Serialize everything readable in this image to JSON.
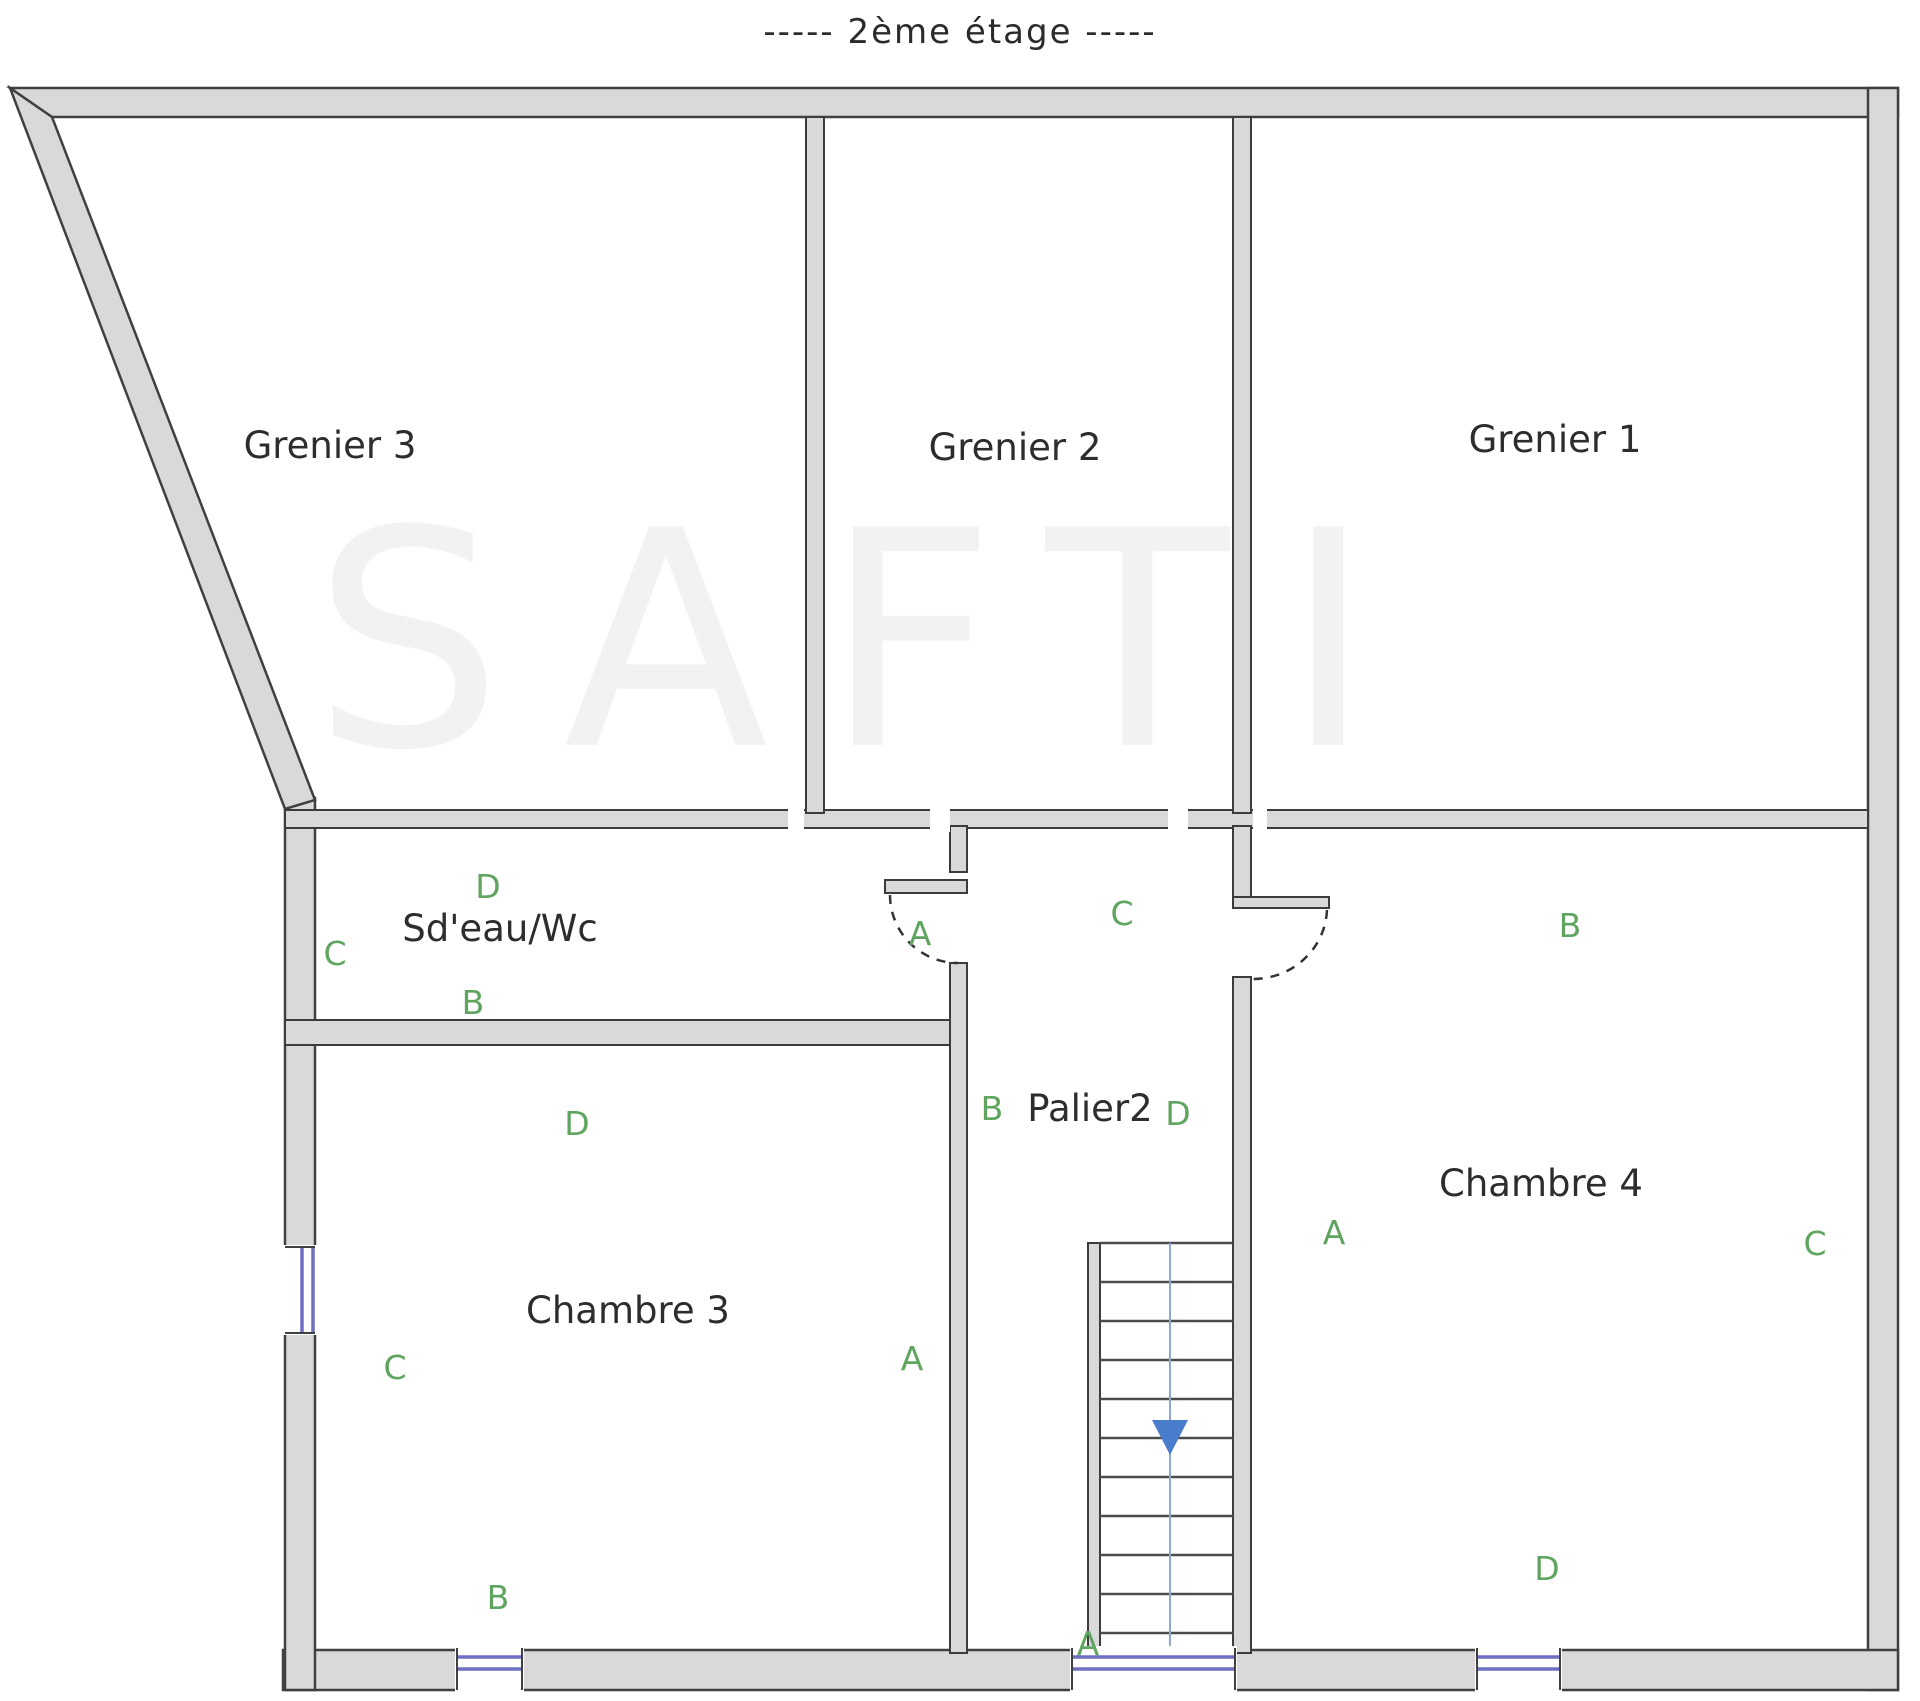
{
  "title": {
    "text": "-----  2ème étage  -----"
  },
  "watermark": {
    "text": "SAFTI"
  },
  "colors": {
    "wall_fill": "#d9d9d9",
    "wall_stroke": "#404040",
    "window_glass": "#6e6ec2",
    "orientation_letter": "#5fa55f",
    "stairs_arrow": "#4a7ccc",
    "room_label": "#2d2d2d",
    "title": "#2b2b2b"
  },
  "canvas": {
    "width": 1920,
    "height": 1701
  },
  "rooms": [
    {
      "name": "room-label-grenier-3",
      "label": "Grenier 3",
      "x": 330,
      "y": 458
    },
    {
      "name": "room-label-grenier-2",
      "label": "Grenier 2",
      "x": 1015,
      "y": 460
    },
    {
      "name": "room-label-grenier-1",
      "label": "Grenier 1",
      "x": 1555,
      "y": 452
    },
    {
      "name": "room-label-sdeau-wc",
      "label": "Sd'eau/Wc",
      "x": 500,
      "y": 941
    },
    {
      "name": "room-label-palier2",
      "label": "Palier2",
      "x": 1090,
      "y": 1121
    },
    {
      "name": "room-label-chambre-3",
      "label": "Chambre 3",
      "x": 628,
      "y": 1323
    },
    {
      "name": "room-label-chambre-4",
      "label": "Chambre 4",
      "x": 1541,
      "y": 1196
    }
  ],
  "orientation_letters": [
    {
      "name": "letter-d-sdeau",
      "letter": "D",
      "x": 488,
      "y": 898
    },
    {
      "name": "letter-c-sdeau",
      "letter": "C",
      "x": 335,
      "y": 965
    },
    {
      "name": "letter-b-sdeau",
      "letter": "B",
      "x": 473,
      "y": 1014
    },
    {
      "name": "letter-a-sdeau",
      "letter": "A",
      "x": 920,
      "y": 945
    },
    {
      "name": "letter-c-palier",
      "letter": "C",
      "x": 1122,
      "y": 925
    },
    {
      "name": "letter-b-palier",
      "letter": "B",
      "x": 992,
      "y": 1120
    },
    {
      "name": "letter-d-palier",
      "letter": "D",
      "x": 1178,
      "y": 1125
    },
    {
      "name": "letter-a-palier",
      "letter": "A",
      "x": 1088,
      "y": 1655
    },
    {
      "name": "letter-d-chambre3",
      "letter": "D",
      "x": 577,
      "y": 1135
    },
    {
      "name": "letter-c-chambre3",
      "letter": "C",
      "x": 395,
      "y": 1379
    },
    {
      "name": "letter-b-chambre3",
      "letter": "B",
      "x": 498,
      "y": 1609
    },
    {
      "name": "letter-a-chambre3",
      "letter": "A",
      "x": 912,
      "y": 1370
    },
    {
      "name": "letter-b-chambre4",
      "letter": "B",
      "x": 1570,
      "y": 937
    },
    {
      "name": "letter-a-chambre4",
      "letter": "A",
      "x": 1334,
      "y": 1244
    },
    {
      "name": "letter-c-chambre4",
      "letter": "C",
      "x": 1815,
      "y": 1255
    },
    {
      "name": "letter-d-chambre4",
      "letter": "D",
      "x": 1547,
      "y": 1580
    }
  ],
  "shapes": [
    {
      "name": "top-wall",
      "type": "polygon",
      "cls": "wx",
      "attrs": {
        "points": "10,88 1898,88 1898,117 52,117"
      }
    },
    {
      "name": "right-wall",
      "type": "rect",
      "cls": "wx",
      "attrs": {
        "x": 1868,
        "y": 88,
        "width": 30,
        "height": 1602
      }
    },
    {
      "name": "bottom-wall",
      "type": "rect",
      "cls": "wx",
      "attrs": {
        "x": 283,
        "y": 1650,
        "width": 1615,
        "height": 40
      }
    },
    {
      "name": "left-wall",
      "type": "rect",
      "cls": "wx",
      "attrs": {
        "x": 285,
        "y": 798,
        "width": 30,
        "height": 892
      }
    },
    {
      "name": "slanted-wall",
      "type": "polygon",
      "cls": "wx",
      "attrs": {
        "points": "10,88 52,117 315,800 285,809"
      }
    },
    {
      "name": "greniers-bottom-wall",
      "type": "rect",
      "cls": "wi",
      "attrs": {
        "x": 285,
        "y": 810,
        "width": 1583,
        "height": 18
      }
    },
    {
      "name": "wall-grenier3-grenier2",
      "type": "rect",
      "cls": "wi",
      "attrs": {
        "x": 806,
        "y": 117,
        "width": 18,
        "height": 696
      }
    },
    {
      "name": "wall-grenier2-grenier1",
      "type": "rect",
      "cls": "wi",
      "attrs": {
        "x": 1233,
        "y": 117,
        "width": 18,
        "height": 696
      }
    },
    {
      "name": "sdeau-bottom-wall",
      "type": "rect",
      "cls": "wi",
      "attrs": {
        "x": 285,
        "y": 1020,
        "width": 682,
        "height": 25
      }
    },
    {
      "name": "palier-left-wall-upper",
      "type": "rect",
      "cls": "wi",
      "attrs": {
        "x": 950,
        "y": 826,
        "width": 17,
        "height": 46
      }
    },
    {
      "name": "sdeau-door-stub",
      "type": "rect",
      "cls": "wi",
      "attrs": {
        "x": 885,
        "y": 880,
        "width": 82,
        "height": 13
      }
    },
    {
      "name": "palier-left-wall-lower",
      "type": "rect",
      "cls": "wi",
      "attrs": {
        "x": 950,
        "y": 963,
        "width": 17,
        "height": 690
      }
    },
    {
      "name": "chambre4-left-wall-upper",
      "type": "rect",
      "cls": "wi",
      "attrs": {
        "x": 1233,
        "y": 826,
        "width": 18,
        "height": 73
      }
    },
    {
      "name": "chambre4-door-stub",
      "type": "rect",
      "cls": "wi",
      "attrs": {
        "x": 1233,
        "y": 897,
        "width": 96,
        "height": 11
      }
    },
    {
      "name": "chambre4-left-wall-lower",
      "type": "rect",
      "cls": "wi",
      "attrs": {
        "x": 1233,
        "y": 977,
        "width": 18,
        "height": 676
      }
    },
    {
      "name": "stairs-left-wall",
      "type": "rect",
      "cls": "wi",
      "attrs": {
        "x": 1088,
        "y": 1243,
        "width": 12,
        "height": 407
      }
    },
    {
      "name": "band-opening-1",
      "type": "rect",
      "cls": "gap",
      "attrs": {
        "x": 788,
        "y": 806,
        "width": 16,
        "height": 26
      }
    },
    {
      "name": "band-opening-2",
      "type": "rect",
      "cls": "gap",
      "attrs": {
        "x": 930,
        "y": 806,
        "width": 20,
        "height": 26
      }
    },
    {
      "name": "band-opening-3",
      "type": "rect",
      "cls": "gap",
      "attrs": {
        "x": 1168,
        "y": 806,
        "width": 20,
        "height": 26
      }
    },
    {
      "name": "band-opening-4",
      "type": "rect",
      "cls": "gap",
      "attrs": {
        "x": 1253,
        "y": 806,
        "width": 14,
        "height": 26
      }
    },
    {
      "name": "left-window-gap",
      "type": "rect",
      "cls": "gap",
      "attrs": {
        "x": 281,
        "y": 1245,
        "width": 36,
        "height": 90
      }
    },
    {
      "name": "left-window-glass-1",
      "type": "line",
      "cls": "win",
      "attrs": {
        "x1": 302,
        "y1": 1247,
        "x2": 302,
        "y2": 1333
      }
    },
    {
      "name": "left-window-glass-2",
      "type": "line",
      "cls": "win",
      "attrs": {
        "x1": 313,
        "y1": 1247,
        "x2": 313,
        "y2": 1333
      }
    },
    {
      "name": "left-window-jamb-top",
      "type": "line",
      "cls": "jamb",
      "attrs": {
        "x1": 285,
        "y1": 1247,
        "x2": 315,
        "y2": 1247
      }
    },
    {
      "name": "left-window-jamb-bottom",
      "type": "line",
      "cls": "jamb",
      "attrs": {
        "x1": 285,
        "y1": 1333,
        "x2": 315,
        "y2": 1333
      }
    },
    {
      "name": "bottom-window1-gap",
      "type": "rect",
      "cls": "gap",
      "attrs": {
        "x": 455,
        "y": 1646,
        "width": 69,
        "height": 46
      }
    },
    {
      "name": "bottom-window1-glass-1",
      "type": "line",
      "cls": "win",
      "attrs": {
        "x1": 457,
        "y1": 1657,
        "x2": 522,
        "y2": 1657
      }
    },
    {
      "name": "bottom-window1-glass-2",
      "type": "line",
      "cls": "win",
      "attrs": {
        "x1": 457,
        "y1": 1669,
        "x2": 522,
        "y2": 1669
      }
    },
    {
      "name": "bottom-window1-jamb-left",
      "type": "line",
      "cls": "jamb",
      "attrs": {
        "x1": 457,
        "y1": 1648,
        "x2": 457,
        "y2": 1690
      }
    },
    {
      "name": "bottom-window1-jamb-right",
      "type": "line",
      "cls": "jamb",
      "attrs": {
        "x1": 522,
        "y1": 1648,
        "x2": 522,
        "y2": 1690
      }
    },
    {
      "name": "bottom-window2-gap",
      "type": "rect",
      "cls": "gap",
      "attrs": {
        "x": 1070,
        "y": 1646,
        "width": 167,
        "height": 46
      }
    },
    {
      "name": "bottom-window2-glass-1",
      "type": "line",
      "cls": "win",
      "attrs": {
        "x1": 1072,
        "y1": 1657,
        "x2": 1235,
        "y2": 1657
      }
    },
    {
      "name": "bottom-window2-glass-2",
      "type": "line",
      "cls": "win",
      "attrs": {
        "x1": 1072,
        "y1": 1669,
        "x2": 1235,
        "y2": 1669
      }
    },
    {
      "name": "bottom-window2-jamb-left",
      "type": "line",
      "cls": "jamb",
      "attrs": {
        "x1": 1072,
        "y1": 1648,
        "x2": 1072,
        "y2": 1690
      }
    },
    {
      "name": "bottom-window2-jamb-right",
      "type": "line",
      "cls": "jamb",
      "attrs": {
        "x1": 1235,
        "y1": 1648,
        "x2": 1235,
        "y2": 1690
      }
    },
    {
      "name": "bottom-window3-gap",
      "type": "rect",
      "cls": "gap",
      "attrs": {
        "x": 1475,
        "y": 1646,
        "width": 87,
        "height": 46
      }
    },
    {
      "name": "bottom-window3-glass-1",
      "type": "line",
      "cls": "win",
      "attrs": {
        "x1": 1477,
        "y1": 1657,
        "x2": 1560,
        "y2": 1657
      }
    },
    {
      "name": "bottom-window3-glass-2",
      "type": "line",
      "cls": "win",
      "attrs": {
        "x1": 1477,
        "y1": 1669,
        "x2": 1560,
        "y2": 1669
      }
    },
    {
      "name": "bottom-window3-jamb-left",
      "type": "line",
      "cls": "jamb",
      "attrs": {
        "x1": 1477,
        "y1": 1648,
        "x2": 1477,
        "y2": 1690
      }
    },
    {
      "name": "bottom-window3-jamb-right",
      "type": "line",
      "cls": "jamb",
      "attrs": {
        "x1": 1560,
        "y1": 1648,
        "x2": 1560,
        "y2": 1690
      }
    },
    {
      "name": "sdeau-door-arc",
      "type": "path",
      "cls": "door",
      "attrs": {
        "d": "M 890 895 A 68 68 0 0 0 958 963"
      }
    },
    {
      "name": "chambre4-door-arc",
      "type": "path",
      "cls": "door",
      "attrs": {
        "d": "M 1327 910 A 74 72 0 0 1 1253 979"
      }
    },
    {
      "name": "stair-tread-1",
      "type": "line",
      "cls": "tread",
      "attrs": {
        "x1": 1100,
        "y1": 1243,
        "x2": 1233,
        "y2": 1243
      }
    },
    {
      "name": "stair-tread-2",
      "type": "line",
      "cls": "tread",
      "attrs": {
        "x1": 1100,
        "y1": 1282,
        "x2": 1233,
        "y2": 1282
      }
    },
    {
      "name": "stair-tread-3",
      "type": "line",
      "cls": "tread",
      "attrs": {
        "x1": 1100,
        "y1": 1321,
        "x2": 1233,
        "y2": 1321
      }
    },
    {
      "name": "stair-tread-4",
      "type": "line",
      "cls": "tread",
      "attrs": {
        "x1": 1100,
        "y1": 1360,
        "x2": 1233,
        "y2": 1360
      }
    },
    {
      "name": "stair-tread-5",
      "type": "line",
      "cls": "tread",
      "attrs": {
        "x1": 1100,
        "y1": 1399,
        "x2": 1233,
        "y2": 1399
      }
    },
    {
      "name": "stair-tread-6",
      "type": "line",
      "cls": "tread",
      "attrs": {
        "x1": 1100,
        "y1": 1438,
        "x2": 1233,
        "y2": 1438
      }
    },
    {
      "name": "stair-tread-7",
      "type": "line",
      "cls": "tread",
      "attrs": {
        "x1": 1100,
        "y1": 1477,
        "x2": 1233,
        "y2": 1477
      }
    },
    {
      "name": "stair-tread-8",
      "type": "line",
      "cls": "tread",
      "attrs": {
        "x1": 1100,
        "y1": 1516,
        "x2": 1233,
        "y2": 1516
      }
    },
    {
      "name": "stair-tread-9",
      "type": "line",
      "cls": "tread",
      "attrs": {
        "x1": 1100,
        "y1": 1555,
        "x2": 1233,
        "y2": 1555
      }
    },
    {
      "name": "stair-tread-10",
      "type": "line",
      "cls": "tread",
      "attrs": {
        "x1": 1100,
        "y1": 1594,
        "x2": 1233,
        "y2": 1594
      }
    },
    {
      "name": "stair-tread-11",
      "type": "line",
      "cls": "tread",
      "attrs": {
        "x1": 1100,
        "y1": 1633,
        "x2": 1233,
        "y2": 1633
      }
    },
    {
      "name": "stairs-direction-line",
      "type": "line",
      "cls": "sline",
      "attrs": {
        "x1": 1170,
        "y1": 1243,
        "x2": 1170,
        "y2": 1646
      }
    },
    {
      "name": "stairs-down-arrow",
      "type": "polygon",
      "cls": "sarrow",
      "attrs": {
        "points": "1152,1420 1188,1420 1170,1455"
      }
    }
  ]
}
